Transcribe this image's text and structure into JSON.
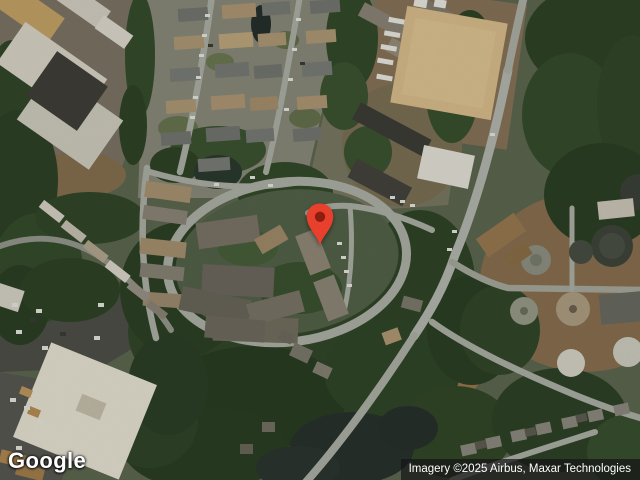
{
  "map": {
    "view_type": "satellite",
    "marker": {
      "name": "location-pin",
      "body_color": "#E8402C",
      "dot_color": "#8C1D10"
    }
  },
  "branding": {
    "logo_text": "Google"
  },
  "attribution": {
    "text": "Imagery ©2025 Airbus, Maxar Technologies"
  }
}
